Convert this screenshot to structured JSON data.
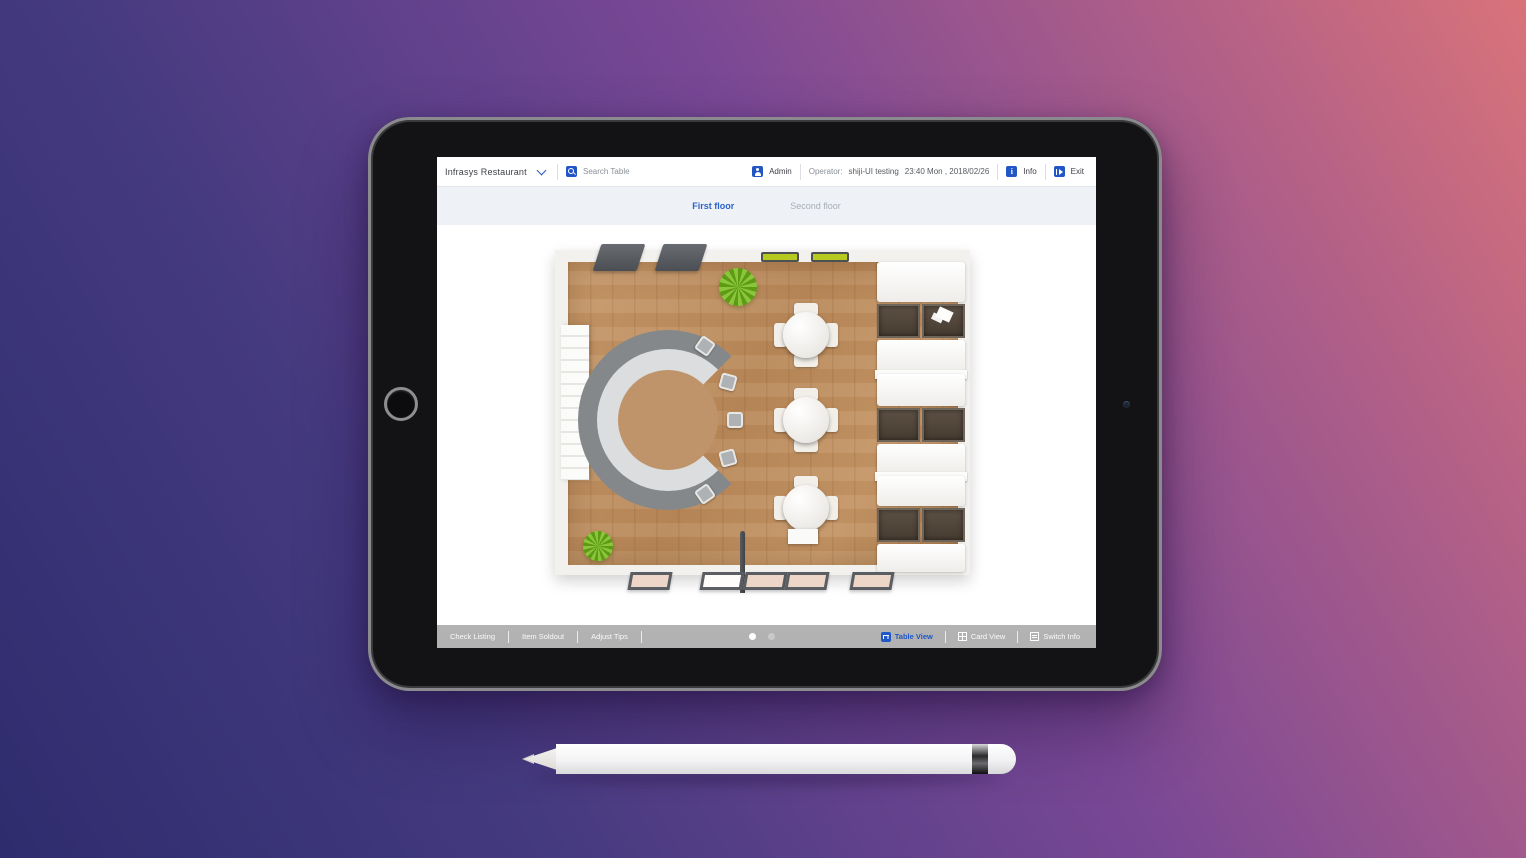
{
  "header": {
    "restaurant_name": "Infrasys Restaurant",
    "search_placeholder": "Search Table",
    "admin_label": "Admin",
    "operator_label": "Operator:",
    "operator_name": "shiji-UI testing",
    "datetime": "23:40 Mon , 2018/02/26",
    "info_label": "Info",
    "exit_label": "Exit"
  },
  "floor_tabs": [
    {
      "label": "First floor",
      "active": true
    },
    {
      "label": "Second floor",
      "active": false
    }
  ],
  "toolbar": {
    "check_listing_label": "Check Listing",
    "item_soldout_label": "Item Soldout",
    "adjust_tips_label": "Adjust Tips",
    "table_view_label": "Table View",
    "card_view_label": "Card View",
    "switch_info_label": "Switch Info",
    "page_dots": {
      "count": 2,
      "active_index": 0
    }
  },
  "icons": {
    "dropdown": "chevron-down",
    "search": "magnifier",
    "admin": "person-badge",
    "info": "info-square",
    "exit": "logout-square",
    "table_view": "table-glyph",
    "card_view": "grid-glyph",
    "switch_info": "swap-glyph"
  },
  "colors": {
    "accent_blue": "#2356c5",
    "active_tab": "#2c63c8",
    "inactive_tab": "#a9aeb6",
    "tabbar_bg": "#eef1f6",
    "toolbar_bg": "#b2b2b2",
    "background_gradient": [
      "#2e2c6e",
      "#7a4895",
      "#d9737a"
    ]
  }
}
